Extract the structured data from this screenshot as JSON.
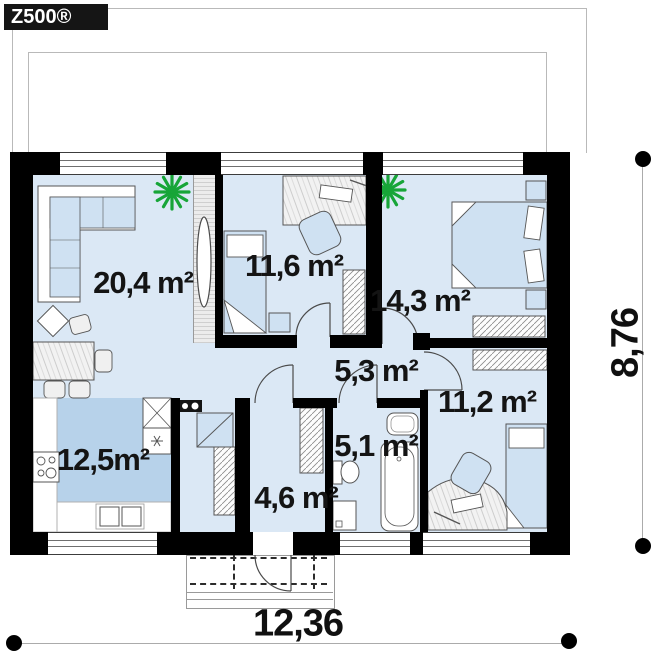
{
  "logo": {
    "text": "Z500®"
  },
  "plan": {
    "title": "single-storey house floor plan",
    "rooms": [
      {
        "name": "living-room",
        "area_label": "20,4 m²"
      },
      {
        "name": "bedroom-left",
        "area_label": "11,6 m²"
      },
      {
        "name": "bedroom-master",
        "area_label": "14,3 m²"
      },
      {
        "name": "hallway",
        "area_label": "5,3 m²"
      },
      {
        "name": "bedroom-right",
        "area_label": "11,2 m²"
      },
      {
        "name": "kitchen",
        "area_label": "12,5m²"
      },
      {
        "name": "entry-hall",
        "area_label": "4,6 m²"
      },
      {
        "name": "bathroom",
        "area_label": "5,1 m²"
      }
    ],
    "dimensions": {
      "width_label": "12,36",
      "height_label": "8,76"
    },
    "colors": {
      "wall": "#000000",
      "floor": "#dbe8f5",
      "kitchen_floor": "#b7d2ea",
      "furniture_blue": "#cfe1f2",
      "plant_green": "#17a538",
      "dimension_line": "#ababab"
    }
  }
}
